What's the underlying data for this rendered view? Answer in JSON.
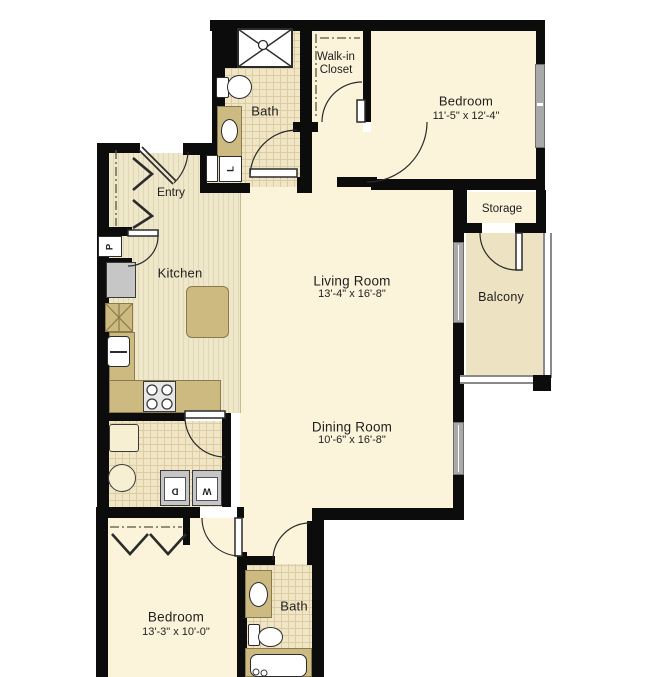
{
  "title": "Apartment floor plan",
  "rooms": {
    "bath_upper": {
      "label": "Bath"
    },
    "walk_in_closet": {
      "label_line1": "Walk-in",
      "label_line2": "Closet"
    },
    "bedroom_upper": {
      "label": "Bedroom",
      "dimensions": "11'-5\" x 12'-4\""
    },
    "storage": {
      "label": "Storage"
    },
    "balcony": {
      "label": "Balcony"
    },
    "entry": {
      "label": "Entry"
    },
    "kitchen": {
      "label": "Kitchen"
    },
    "living_room": {
      "label": "Living Room",
      "dimensions": "13'-4\" x 16'-8\""
    },
    "dining_room": {
      "label": "Dining Room",
      "dimensions": "10'-6\" x 16'-8\""
    },
    "bedroom_lower": {
      "label": "Bedroom",
      "dimensions": "13'-3\" x 10'-0\""
    },
    "bath_lower": {
      "label": "Bath"
    }
  },
  "closet_marks": {
    "pantry": "P",
    "linen": "L",
    "washer": "W",
    "dryer": "D"
  },
  "colors": {
    "wall": "#0c0c0c",
    "room_fill": "#FBF3DA",
    "accent_tan": "#CDBA80",
    "tile_fill": "#F0E6C6",
    "balcony_fill": "#EDE2C1",
    "window_gray": "#A9A9A9"
  }
}
